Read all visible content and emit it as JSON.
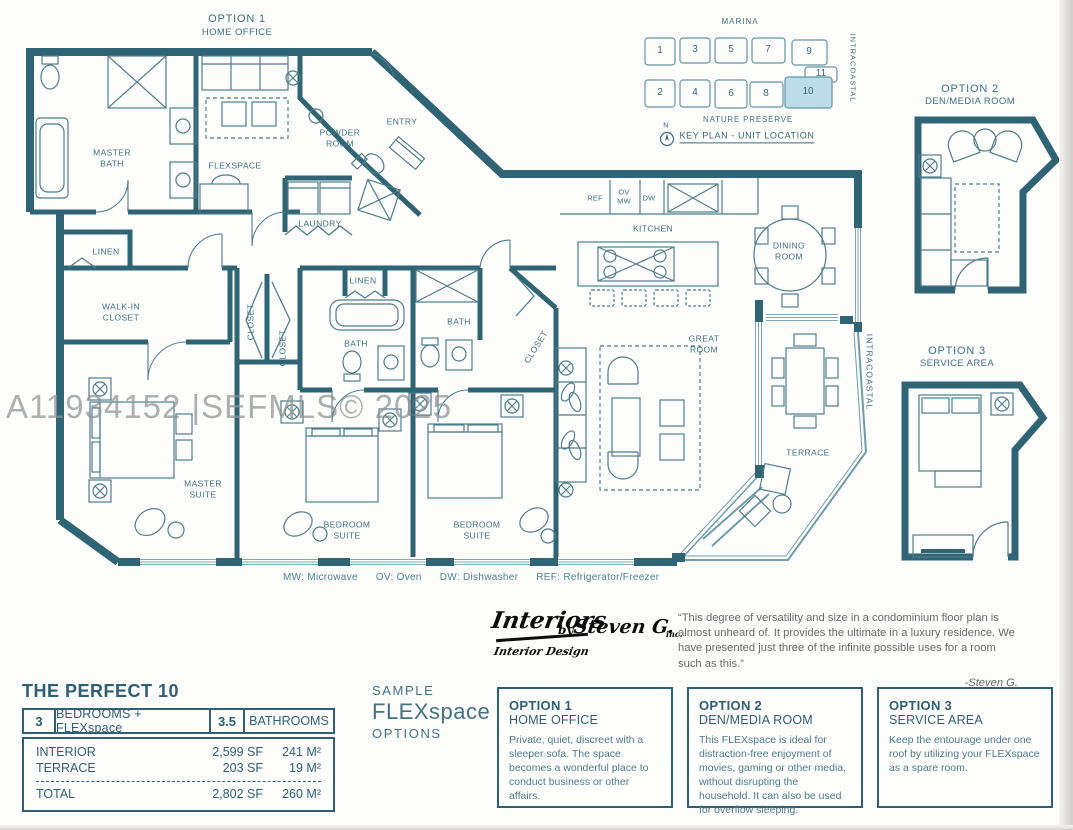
{
  "watermark": "A11934152 |SEFMLS© 2025",
  "colors": {
    "wall": "#2e6474",
    "label": "#3f7181",
    "highlight": "#bcdeea",
    "accent": "#2e5f72"
  },
  "plan": {
    "option1": {
      "title": "OPTION 1",
      "subtitle": "HOME OFFICE"
    },
    "labels": [
      "MASTER\nBATH",
      "FLEXSPACE",
      "POWDER\nROOM",
      "ENTRY",
      "LAUNDRY",
      "LINEN",
      "WALK-IN\nCLOSET",
      "CLOSET",
      "CLOSET",
      "LINEN",
      "BATH",
      "BATH",
      "CLOSET",
      "MASTER\nSUITE",
      "BEDROOM\nSUITE",
      "BEDROOM\nSUITE",
      "KITCHEN",
      "DINING\nROOM",
      "GREAT\nROOM",
      "TERRACE",
      "INTRACOASTAL",
      "REF",
      "OV\nMW",
      "DW"
    ]
  },
  "keyplan": {
    "marina": "MARINA",
    "intracoastal": "INTRACOASTAL",
    "nature_preserve": "NATURE PRESERVE",
    "north": "N",
    "caption": "KEY PLAN - UNIT LOCATION",
    "units": [
      "1",
      "3",
      "5",
      "7",
      "9",
      "11",
      "2",
      "4",
      "6",
      "8",
      "10"
    ],
    "highlighted_unit": "10"
  },
  "option2_plan": {
    "title": "OPTION 2",
    "subtitle": "DEN/MEDIA ROOM"
  },
  "option3_plan": {
    "title": "OPTION 3",
    "subtitle": "SERVICE AREA"
  },
  "legend": {
    "items": [
      "MW: Microwave",
      "OV: Oven",
      "DW: Dishwasher",
      "REF: Refrigerator/Freezer"
    ]
  },
  "logo": {
    "name": "Interiors",
    "by": "by",
    "name2": "Steven G.",
    "inc": "inc.",
    "tagline": "Interior Design"
  },
  "quote": {
    "text": "“This degree of versatility and size in a condominium floor plan is almost unheard of. It provides the ultimate in a luxury residence. We have presented just three of the infinite possible uses for a room such as this.”",
    "attribution": "-Steven G."
  },
  "summary": {
    "title": "THE PERFECT 10",
    "bedrooms_count": "3",
    "bedrooms_label": "BEDROOMS + FLEXspace",
    "bathrooms_count": "3.5",
    "bathrooms_label": "BATHROOMS",
    "rows": [
      {
        "label": "INTERIOR",
        "sf": "2,599 SF",
        "m2": "241 M²"
      },
      {
        "label": "TERRACE",
        "sf": "203 SF",
        "m2": "19 M²"
      }
    ],
    "total": {
      "label": "TOTAL",
      "sf": "2,802 SF",
      "m2": "260 M²"
    }
  },
  "sample": {
    "line1": "SAMPLE",
    "line2": "FLEXspace",
    "line3": "OPTIONS"
  },
  "flex_options": [
    {
      "title": "OPTION 1",
      "subtitle": "HOME OFFICE",
      "body": "Private, quiet, discreet with a sleeper sofa. The space becomes a wonderful place to conduct business or other affairs."
    },
    {
      "title": "OPTION 2",
      "subtitle": "DEN/MEDIA ROOM",
      "body": "This FLEXspace is ideal for distraction-free enjoyment of movies, gaming or other media, without disrupting the household. It can also be used for overflow sleeping."
    },
    {
      "title": "OPTION 3",
      "subtitle": "SERVICE AREA",
      "body": "Keep the entourage under one roof by utilizing your FLEXspace as a spare room."
    }
  ]
}
